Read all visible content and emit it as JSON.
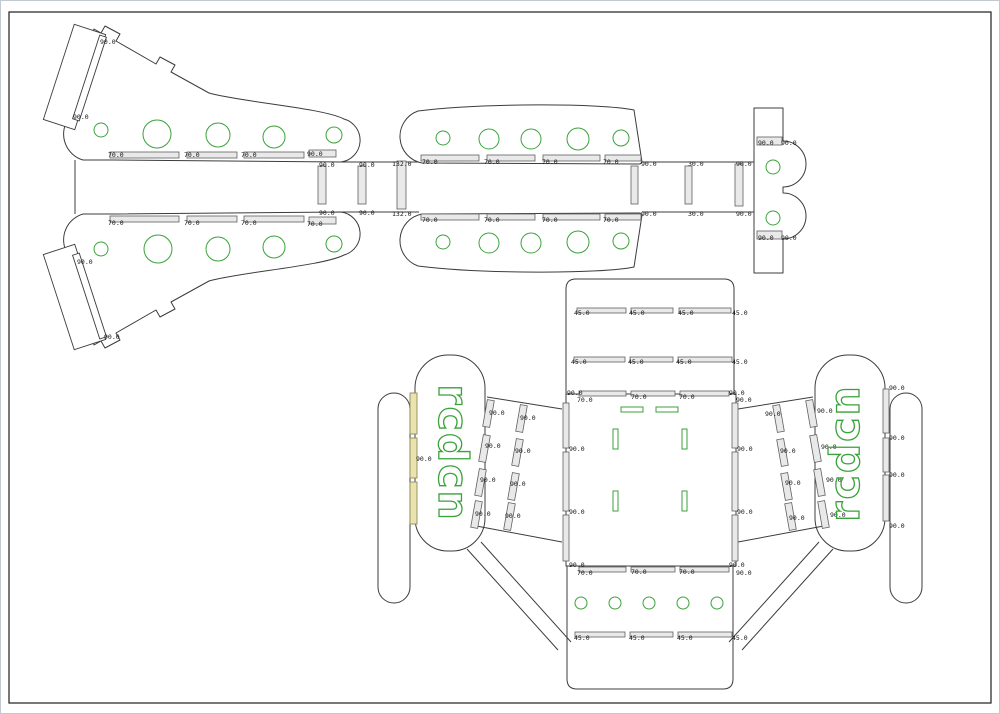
{
  "canvas": {
    "width": 1000,
    "height": 714,
    "background": "#ffffff",
    "frame_color": "#c3c9d2",
    "border_color": "#1d1d1d"
  },
  "colors": {
    "outline": "#3c3c3c",
    "slot_fill": "#e9e9e9",
    "green": "#3aa23a",
    "yellow_fill": "#eae3ae",
    "label": "#141414"
  },
  "brand": {
    "text": "rcdcn"
  },
  "labels": [
    [
      99,
      40,
      "90.0"
    ],
    [
      72,
      115,
      "90.0"
    ],
    [
      107,
      153,
      "70.0"
    ],
    [
      183,
      153,
      "70.0"
    ],
    [
      240,
      153,
      "70.0"
    ],
    [
      306,
      152,
      "90.0"
    ],
    [
      107,
      221,
      "70.0"
    ],
    [
      183,
      221,
      "70.0"
    ],
    [
      240,
      221,
      "70.0"
    ],
    [
      306,
      222,
      "70.0"
    ],
    [
      318,
      163,
      "90.0"
    ],
    [
      318,
      211,
      "90.0"
    ],
    [
      358,
      163,
      "90.0"
    ],
    [
      358,
      211,
      "90.0"
    ],
    [
      391,
      162,
      "132.0"
    ],
    [
      391,
      212,
      "132.0"
    ],
    [
      76,
      260,
      "90.0"
    ],
    [
      103,
      335,
      "90.0"
    ],
    [
      421,
      160,
      "70.0"
    ],
    [
      483,
      160,
      "70.0"
    ],
    [
      541,
      160,
      "70.0"
    ],
    [
      602,
      160,
      "70.0"
    ],
    [
      421,
      218,
      "70.0"
    ],
    [
      483,
      218,
      "70.0"
    ],
    [
      541,
      218,
      "70.0"
    ],
    [
      602,
      218,
      "70.0"
    ],
    [
      640,
      162,
      "90.0"
    ],
    [
      687,
      162,
      "30.0"
    ],
    [
      735,
      162,
      "90.0"
    ],
    [
      640,
      212,
      "90.0"
    ],
    [
      687,
      212,
      "30.0"
    ],
    [
      735,
      212,
      "90.0"
    ],
    [
      757,
      141,
      "90.0"
    ],
    [
      780,
      141,
      "90.0"
    ],
    [
      757,
      236,
      "90.0"
    ],
    [
      780,
      236,
      "90.0"
    ],
    [
      573,
      311,
      "45.0"
    ],
    [
      628,
      311,
      "45.0"
    ],
    [
      677,
      311,
      "45.0"
    ],
    [
      731,
      311,
      "45.0"
    ],
    [
      570,
      360,
      "45.0"
    ],
    [
      627,
      360,
      "45.0"
    ],
    [
      675,
      360,
      "45.0"
    ],
    [
      731,
      360,
      "45.0"
    ],
    [
      566,
      391,
      "90.0"
    ],
    [
      576,
      398,
      "70.0"
    ],
    [
      630,
      395,
      "70.0"
    ],
    [
      678,
      395,
      "70.0"
    ],
    [
      728,
      391,
      "90.0"
    ],
    [
      735,
      398,
      "90.0"
    ],
    [
      568,
      447,
      "90.0"
    ],
    [
      568,
      510,
      "90.0"
    ],
    [
      736,
      447,
      "90.0"
    ],
    [
      736,
      510,
      "90.0"
    ],
    [
      568,
      563,
      "90.0"
    ],
    [
      576,
      571,
      "70.0"
    ],
    [
      630,
      570,
      "70.0"
    ],
    [
      678,
      570,
      "70.0"
    ],
    [
      728,
      563,
      "90.0"
    ],
    [
      735,
      571,
      "90.0"
    ],
    [
      573,
      636,
      "45.0"
    ],
    [
      628,
      636,
      "45.0"
    ],
    [
      676,
      636,
      "45.0"
    ],
    [
      731,
      636,
      "45.0"
    ],
    [
      415,
      457,
      "90.0"
    ],
    [
      488,
      411,
      "90.0"
    ],
    [
      519,
      416,
      "90.0"
    ],
    [
      484,
      444,
      "90.0"
    ],
    [
      514,
      449,
      "90.0"
    ],
    [
      479,
      478,
      "90.0"
    ],
    [
      509,
      482,
      "90.0"
    ],
    [
      474,
      512,
      "90.0"
    ],
    [
      504,
      514,
      "90.0"
    ],
    [
      764,
      412,
      "90.0"
    ],
    [
      816,
      409,
      "90.0"
    ],
    [
      779,
      449,
      "90.0"
    ],
    [
      820,
      445,
      "90.0"
    ],
    [
      784,
      481,
      "90.0"
    ],
    [
      825,
      478,
      "90.0"
    ],
    [
      788,
      516,
      "90.0"
    ],
    [
      829,
      513,
      "90.0"
    ],
    [
      888,
      386,
      "90.0"
    ],
    [
      888,
      436,
      "90.0"
    ],
    [
      888,
      473,
      "90.0"
    ],
    [
      888,
      524,
      "90.0"
    ]
  ],
  "circles": [
    [
      100,
      129,
      7
    ],
    [
      156,
      133,
      14
    ],
    [
      217,
      134,
      12
    ],
    [
      273,
      136,
      11
    ],
    [
      333,
      134,
      8
    ],
    [
      100,
      248,
      7
    ],
    [
      157,
      248,
      14
    ],
    [
      217,
      248,
      12
    ],
    [
      273,
      246,
      11
    ],
    [
      333,
      243,
      8
    ],
    [
      442,
      137,
      7
    ],
    [
      488,
      138,
      10
    ],
    [
      530,
      138,
      10
    ],
    [
      577,
      138,
      11
    ],
    [
      620,
      137,
      8
    ],
    [
      442,
      241,
      7
    ],
    [
      488,
      242,
      10
    ],
    [
      530,
      242,
      10
    ],
    [
      577,
      241,
      11
    ],
    [
      620,
      240,
      8
    ],
    [
      772,
      166,
      7
    ],
    [
      772,
      217,
      7
    ],
    [
      580,
      602,
      6
    ],
    [
      614,
      602,
      6
    ],
    [
      648,
      602,
      6
    ],
    [
      682,
      602,
      6
    ],
    [
      716,
      602,
      6
    ]
  ],
  "green_rects": [
    [
      620,
      406,
      22,
      5
    ],
    [
      655,
      406,
      22,
      5
    ],
    [
      612,
      428,
      5,
      20
    ],
    [
      681,
      428,
      5,
      20
    ],
    [
      612,
      490,
      5,
      20
    ],
    [
      681,
      490,
      5,
      20
    ]
  ],
  "yellow_slots": [
    [
      409,
      392,
      7,
      41
    ],
    [
      409,
      437,
      7,
      40
    ],
    [
      409,
      481,
      7,
      42
    ]
  ],
  "slots": [
    [
      109,
      151,
      69,
      6
    ],
    [
      186,
      151,
      50,
      6
    ],
    [
      243,
      151,
      60,
      6
    ],
    [
      308,
      149,
      27,
      7
    ],
    [
      109,
      215,
      69,
      6
    ],
    [
      186,
      215,
      50,
      6
    ],
    [
      243,
      215,
      60,
      6
    ],
    [
      308,
      216,
      27,
      7
    ],
    [
      420,
      154,
      58,
      6
    ],
    [
      486,
      154,
      48,
      6
    ],
    [
      542,
      154,
      57,
      6
    ],
    [
      604,
      154,
      36,
      6
    ],
    [
      420,
      213,
      58,
      6
    ],
    [
      486,
      213,
      48,
      6
    ],
    [
      542,
      213,
      57,
      6
    ],
    [
      604,
      213,
      36,
      6
    ],
    [
      317,
      165,
      8,
      38
    ],
    [
      357,
      165,
      8,
      38
    ],
    [
      396,
      160,
      9,
      48
    ],
    [
      630,
      165,
      7,
      38
    ],
    [
      684,
      165,
      7,
      38
    ],
    [
      734,
      163,
      8,
      42
    ],
    [
      756,
      136,
      25,
      8
    ],
    [
      756,
      230,
      25,
      8
    ],
    [
      576,
      307,
      49,
      5
    ],
    [
      630,
      307,
      42,
      5
    ],
    [
      678,
      307,
      52,
      5
    ],
    [
      573,
      356,
      51,
      5
    ],
    [
      629,
      356,
      43,
      5
    ],
    [
      677,
      356,
      54,
      5
    ],
    [
      578,
      390,
      47,
      5
    ],
    [
      630,
      390,
      44,
      5
    ],
    [
      679,
      390,
      49,
      5
    ],
    [
      562,
      402,
      6,
      45
    ],
    [
      562,
      451,
      6,
      59
    ],
    [
      562,
      514,
      6,
      46
    ],
    [
      731,
      402,
      6,
      45
    ],
    [
      731,
      451,
      6,
      59
    ],
    [
      731,
      514,
      6,
      46
    ],
    [
      578,
      566,
      47,
      5
    ],
    [
      630,
      566,
      44,
      5
    ],
    [
      679,
      566,
      49,
      5
    ],
    [
      574,
      631,
      50,
      5
    ],
    [
      629,
      631,
      43,
      5
    ],
    [
      677,
      631,
      54,
      5
    ],
    [
      57,
      26,
      33,
      100,
      18,
      "n"
    ],
    [
      85,
      33,
      7,
      88,
      18,
      "n"
    ],
    [
      57,
      246,
      33,
      100,
      -18,
      "n"
    ],
    [
      85,
      251,
      7,
      88,
      -18,
      "n"
    ],
    [
      484,
      399,
      7,
      27,
      10
    ],
    [
      480,
      434,
      7,
      27,
      10
    ],
    [
      476,
      468,
      7,
      27,
      10
    ],
    [
      472,
      500,
      7,
      27,
      10
    ],
    [
      517,
      404,
      7,
      27,
      10
    ],
    [
      513,
      438,
      7,
      27,
      10
    ],
    [
      509,
      472,
      7,
      27,
      10
    ],
    [
      505,
      502,
      7,
      27,
      10
    ],
    [
      807,
      399,
      7,
      27,
      -10
    ],
    [
      811,
      434,
      7,
      27,
      -10
    ],
    [
      815,
      468,
      7,
      27,
      -10
    ],
    [
      819,
      500,
      7,
      27,
      -10
    ],
    [
      774,
      404,
      7,
      27,
      -10
    ],
    [
      778,
      438,
      7,
      27,
      -10
    ],
    [
      782,
      472,
      7,
      27,
      -10
    ],
    [
      786,
      502,
      7,
      27,
      -10
    ],
    [
      882,
      388,
      6,
      44
    ],
    [
      882,
      437,
      6,
      34
    ],
    [
      882,
      474,
      6,
      46
    ]
  ]
}
